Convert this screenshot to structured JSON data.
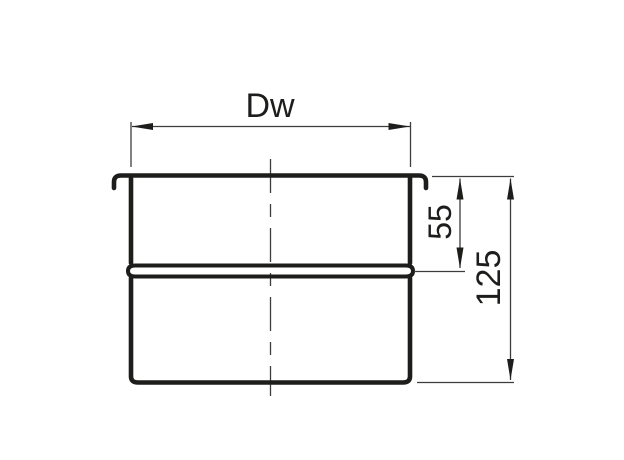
{
  "drawing": {
    "colors": {
      "background": "#ffffff",
      "object_line": "#1d1d1b",
      "dimension_line": "#3d3d3d",
      "text": "#1d1d1b"
    },
    "dimensions": {
      "inner_width": {
        "label": "Dw",
        "orientation": "horizontal"
      },
      "socket_depth": {
        "label": "55",
        "orientation": "vertical"
      },
      "total_height": {
        "label": "125",
        "orientation": "vertical"
      }
    }
  }
}
